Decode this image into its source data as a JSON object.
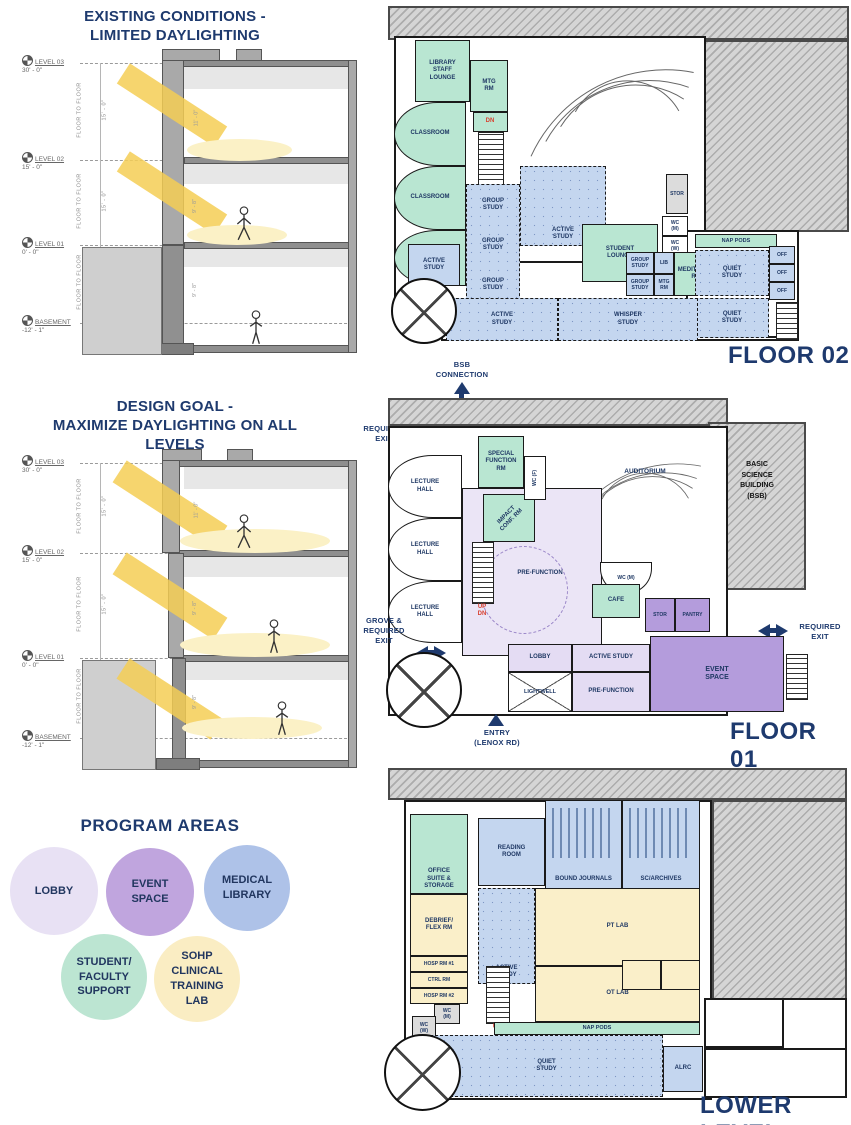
{
  "colors": {
    "navy": "#1E3A6E",
    "red_stair": "#D8402F",
    "lobby": "#E8E1F4",
    "event_space": "#C0A5DE",
    "medical_library": "#AEC2E8",
    "student_faculty_support": "#BCE5D2",
    "sohp_clinical_training_lab": "#FAEDC3",
    "daylight_beam": "#F4CE55"
  },
  "sections": {
    "existing": {
      "title": "EXISTING CONDITIONS -\nLIMITED DAYLIGHTING"
    },
    "design": {
      "title": "DESIGN GOAL -\nMAXIMIZE DAYLIGHTING ON ALL\nLEVELS"
    },
    "levels": [
      {
        "name": "LEVEL 03",
        "elev": "30' - 0\""
      },
      {
        "name": "LEVEL 02",
        "elev": "15' - 0\""
      },
      {
        "name": "LEVEL 01",
        "elev": "0' - 0\""
      },
      {
        "name": "BASEMENT",
        "elev": "-12' - 1\""
      }
    ],
    "floor_to_floor_label": "FLOOR TO FLOOR",
    "floor_to_floor_dims": [
      "15' - 0\"",
      "15' - 0\"",
      "12' - 1\""
    ],
    "room_heights": [
      "11' - 0\"",
      "9' - 8\"",
      "9' - 8\""
    ]
  },
  "program_areas": {
    "title": "PROGRAM AREAS",
    "items": [
      {
        "label": "LOBBY"
      },
      {
        "label": "EVENT\nSPACE"
      },
      {
        "label": "MEDICAL\nLIBRARY"
      },
      {
        "label": "STUDENT/\nFACULTY\nSUPPORT"
      },
      {
        "label": "SOHP\nCLINICAL\nTRAINING\nLAB"
      }
    ]
  },
  "annotations": {
    "bsb_connection": "BSB\nCONNECTION",
    "required_exit": "REQUIRED\nEXIT",
    "grove_required_exit": "GROVE &\nREQUIRED\nEXIT",
    "entry_lenox": "ENTRY\n(LENOX RD)"
  },
  "stairs": {
    "dn": "DN",
    "up_dn": "UP\nDN",
    "up": "UP"
  },
  "floors": {
    "floor02": {
      "name": "FLOOR 02",
      "rooms": {
        "library_staff_lounge": "LIBRARY\nSTAFF\nLOUNGE",
        "classroom_1": "CLASSROOM",
        "classroom_2": "CLASSROOM",
        "classroom_3": "CLASSROOM",
        "active_study_left": "ACTIVE\nSTUDY",
        "mtg_rm": "MTG\nRM",
        "group_study_1": "GROUP\nSTUDY",
        "group_study_2": "GROUP\nSTUDY",
        "group_study_3": "GROUP\nSTUDY",
        "active_study_mid": "ACTIVE\nSTUDY",
        "student_lounge": "STUDENT\nLOUNGE",
        "stor": "STOR",
        "wc_m": "WC\n(M)",
        "wc_w": "WC\n(W)",
        "group_study_a": "GROUP\nSTUDY",
        "group_study_b": "GROUP\nSTUDY",
        "lib": "LIB",
        "mtg_rm_2": "MTG\nRM",
        "meditation_rm": "MEDITATION\nRM",
        "nap_pods": "NAP PODS",
        "off_1": "OFF",
        "off_2": "OFF",
        "off_3": "OFF",
        "quiet_study_1": "QUIET\nSTUDY",
        "quiet_study_2": "QUIET\nSTUDY",
        "active_study_bottom": "ACTIVE\nSTUDY",
        "whisper_study": "WHISPER\nSTUDY"
      }
    },
    "floor01": {
      "name": "FLOOR 01",
      "rooms": {
        "lecture_hall_1": "LECTURE\nHALL",
        "lecture_hall_2": "LECTURE\nHALL",
        "lecture_hall_3": "LECTURE\nHALL",
        "special_function_rm": "SPECIAL\nFUNCTION\nRM",
        "impact_conf_rm": "IMPACT\nCONF. RM",
        "wc_f": "WC (F)",
        "auditorium": "AUDITORIUM",
        "pre_function_main": "PRE-FUNCTION",
        "wc_m": "WC (M)",
        "cafe": "CAFE",
        "stor": "STOR",
        "pantry": "PANTRY",
        "bsb": "BASIC\nSCIENCE\nBUILDING\n(BSB)",
        "lobby": "LOBBY",
        "active_study": "ACTIVE STUDY",
        "event_space": "EVENT\nSPACE",
        "lightwell": "LIGHTWELL",
        "pre_function_2": "PRE-FUNCTION"
      }
    },
    "lower": {
      "name": "LOWER LEVEL",
      "rooms": {
        "office_suite_storage": "OFFICE\nSUITE &\nSTORAGE",
        "reading_room": "READING\nROOM",
        "bound_journals": "BOUND JOURNALS",
        "sc_archives": "SC/ARCHIVES",
        "debrief_flex_rm": "DEBRIEF/\nFLEX RM",
        "active_study": "ACTIVE\nSTUDY",
        "pt_lab": "PT LAB",
        "hosp_rm_1": "HOSP RM #1",
        "ctrl_rm": "CTRL RM",
        "hosp_rm_2": "HOSP RM #2",
        "wc_m": "WC\n(M)",
        "wc_w": "WC\n(W)",
        "ot_lab": "OT LAB",
        "nap_pods": "NAP PODS",
        "quiet_study": "QUIET\nSTUDY",
        "alrc": "ALRC"
      }
    }
  }
}
